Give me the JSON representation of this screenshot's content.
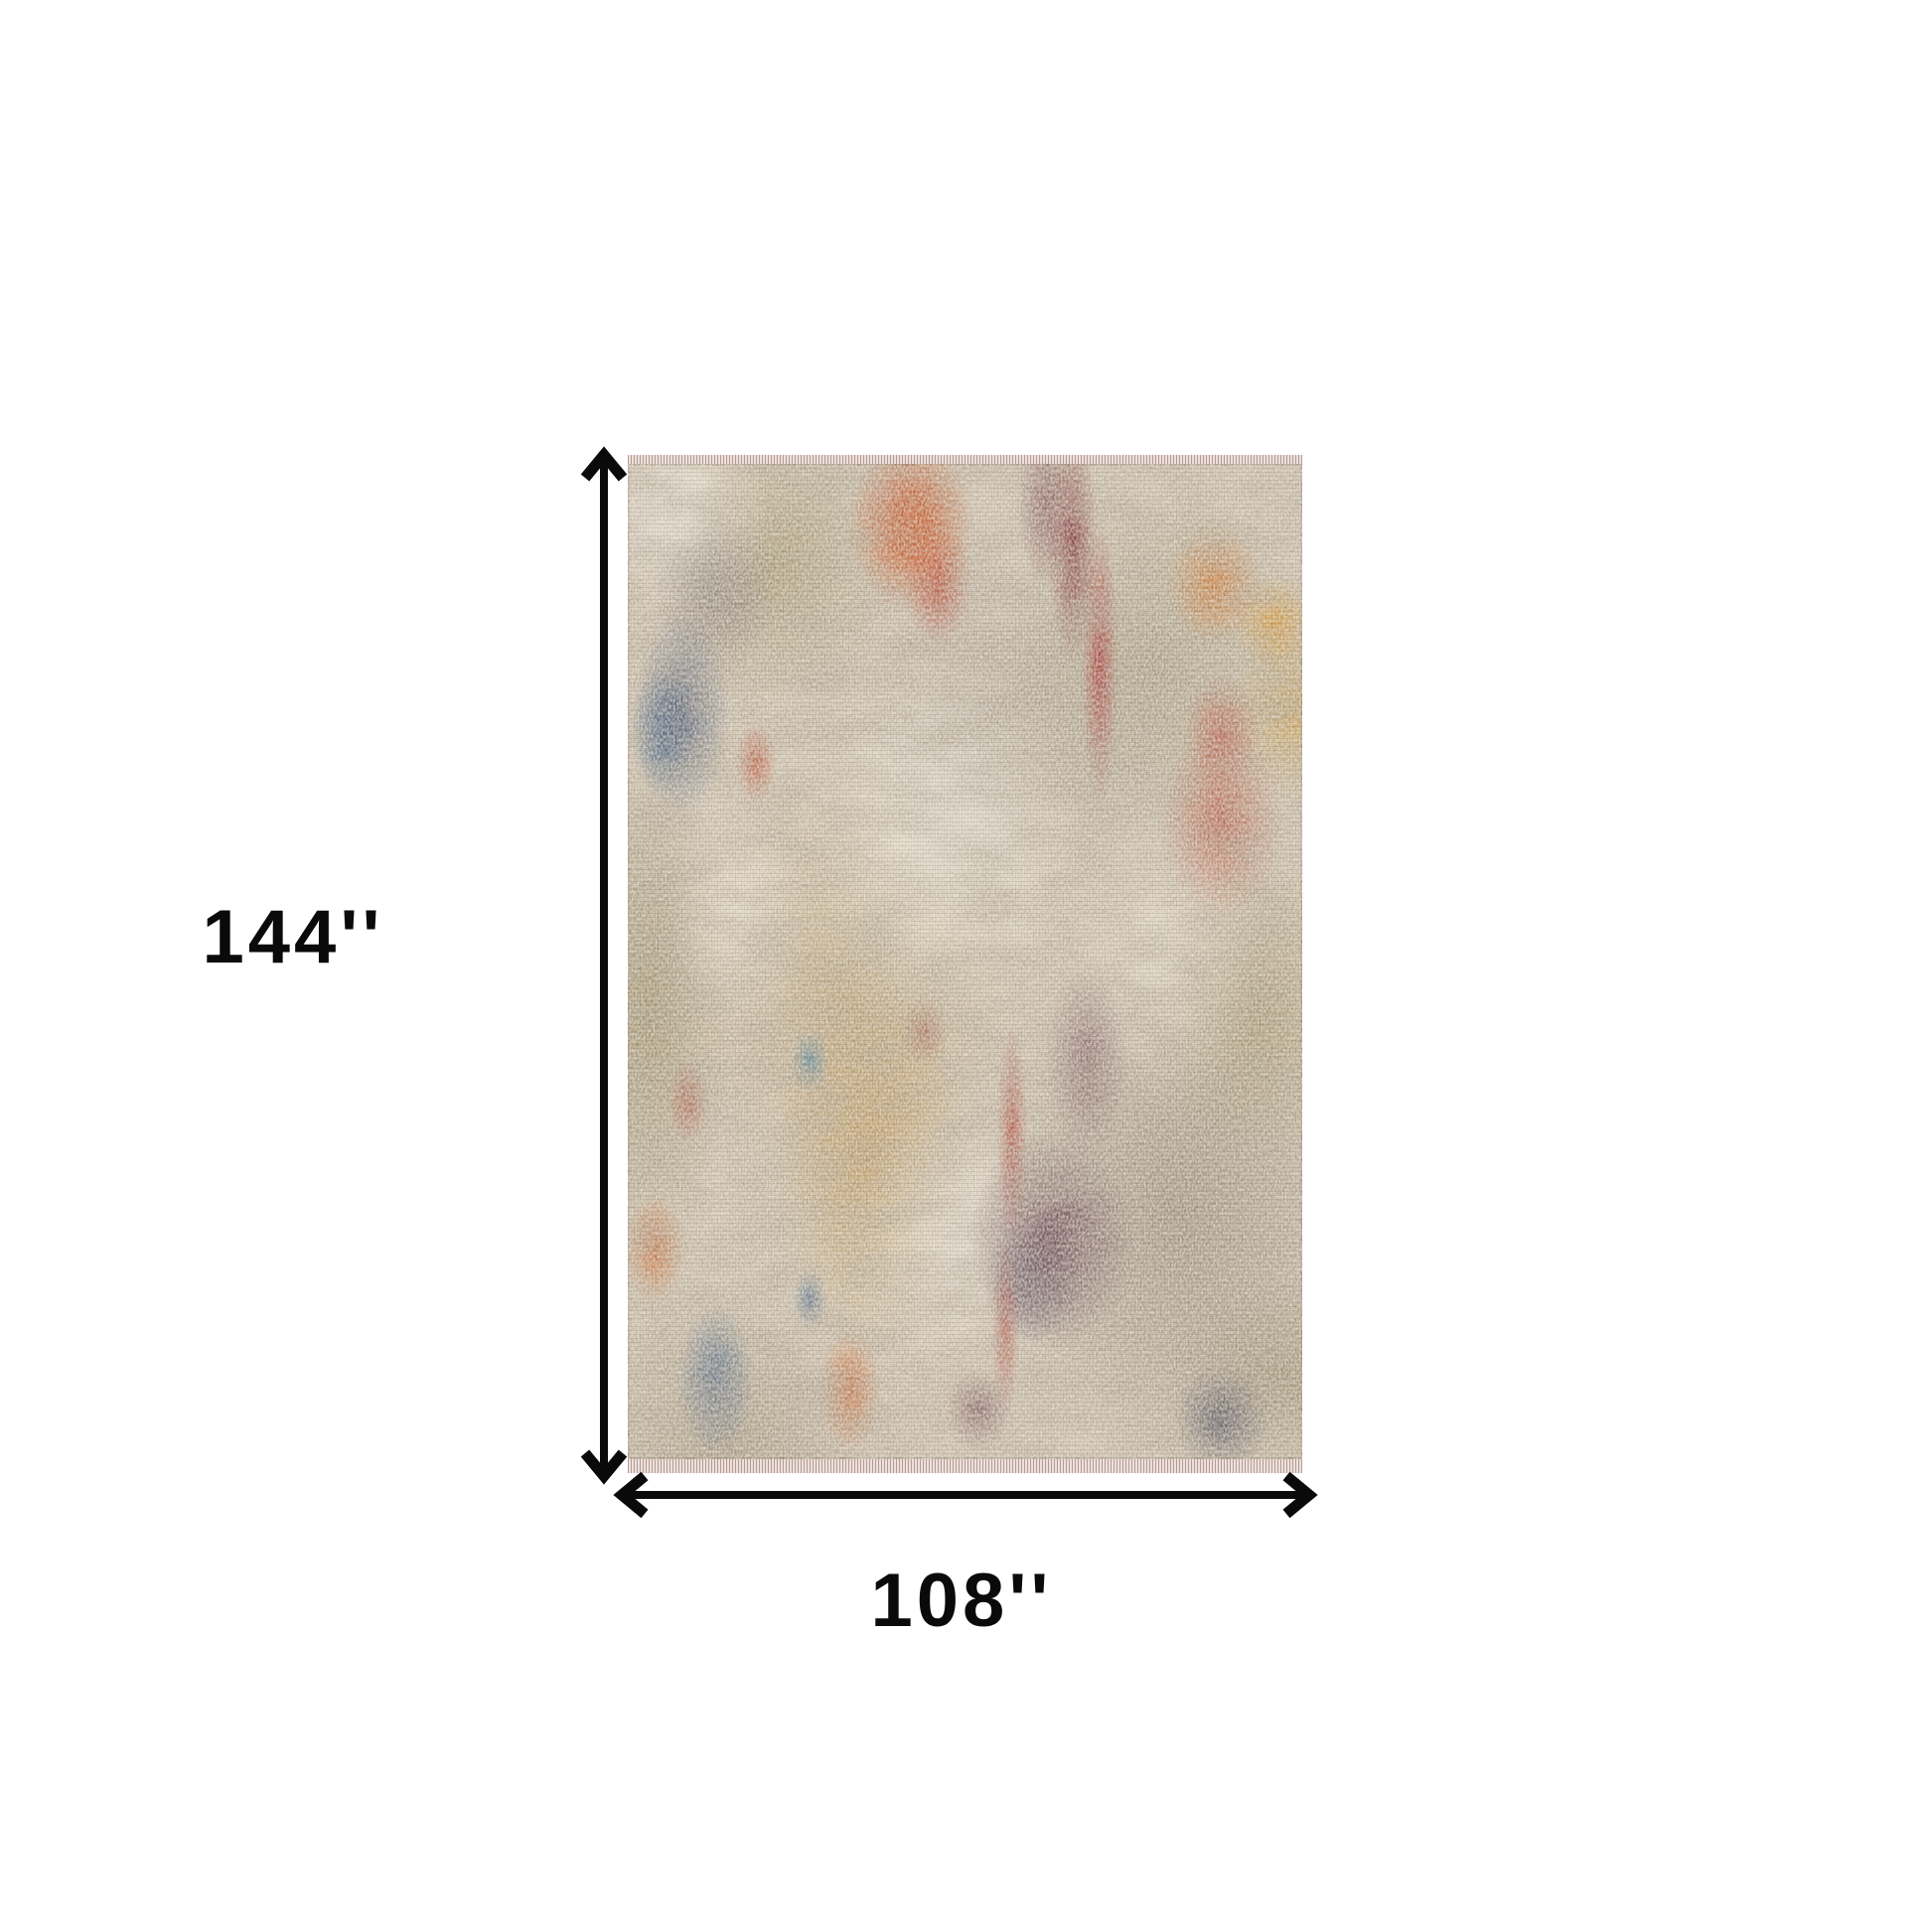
{
  "page": {
    "background": "#ffffff"
  },
  "diagram": {
    "height_label": "144''",
    "width_label": "108''",
    "height_value_inches": 144,
    "width_value_inches": 108,
    "arrow_color": "#0a0a0a",
    "label_color": "#0a0a0a"
  },
  "rug": {
    "description": "Abstract distressed multicolor area rug with fringed top and bottom edges",
    "palette": {
      "base": "#cfc3b0",
      "cream": "#e8e1d2",
      "tan": "#ba9b69",
      "gold": "#c3964e",
      "olive": "#8d7f52",
      "gray_brown": "#87796b",
      "charcoal": "#5b5550",
      "navy": "#374b6e",
      "blue": "#3c6d9e",
      "teal": "#467da0",
      "maroon": "#5c3246",
      "red": "#ad3326",
      "dark_red": "#7c1e28",
      "orange": "#cd5e23",
      "amber": "#d79a3c",
      "fringe": "#dbc7c2"
    }
  }
}
